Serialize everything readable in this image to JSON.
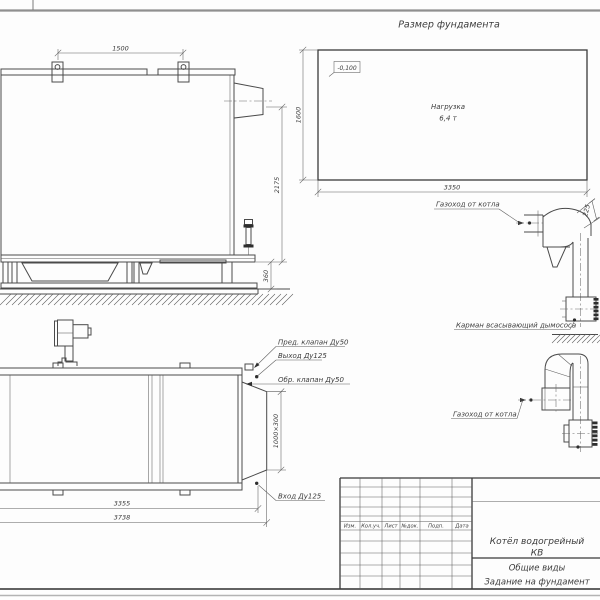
{
  "drawing": {
    "foundation_plan": {
      "title": "Размер фундамента",
      "elevation_mark": "-0,100",
      "load_line1": "Нагрузка",
      "load_line2": "6,4 т",
      "dim_height": "1600",
      "dim_width": "3350"
    },
    "side_view": {
      "dim_lug_spacing": "1500",
      "dim_flue_axis_height": "2175",
      "dim_frame_height": "360"
    },
    "plan_view": {
      "label_safety_valve": "Пред. клапан Ду50",
      "label_outlet": "Выход Ду125",
      "label_check_valve": "Обр. клапан Ду50",
      "label_inlet": "Вход Ду125",
      "dim_outlet_duct": "1000×300",
      "dim_body_length": "3355",
      "dim_overall_length": "3738"
    },
    "flue_side": {
      "label_duct": "Газоход от котла",
      "label_pocket": "Карман всасывающий дымососа",
      "dim_offset": "225"
    },
    "flue_plan": {
      "label_duct": "Газоход от котла"
    },
    "title_block": {
      "columns": [
        "Изм.",
        "Кол.уч.",
        "Лист",
        "№док.",
        "Подп.",
        "Дата"
      ],
      "product_line1": "Котёл водогрейный",
      "product_line2": "КВ",
      "view_type": "Общие виды",
      "assignment": "Задание на фундамент"
    }
  }
}
